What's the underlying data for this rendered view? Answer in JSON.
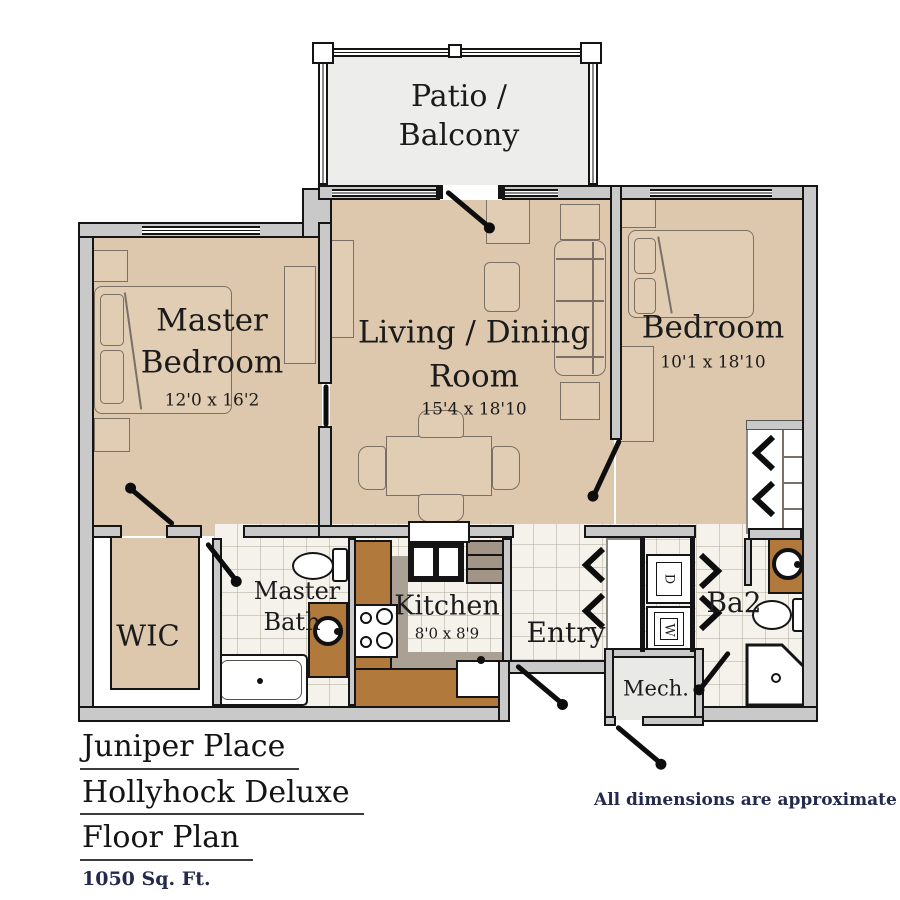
{
  "patio": {
    "line1": "Patio /",
    "line2": "Balcony"
  },
  "rooms": {
    "master_bedroom": {
      "line1": "Master",
      "line2": "Bedroom",
      "dims": "12'0 x 16'2"
    },
    "living": {
      "line1": "Living / Dining",
      "line2": "Room",
      "dims": "15'4 x 18'10"
    },
    "bedroom": {
      "label": "Bedroom",
      "dims": "10'1 x 18'10"
    },
    "wic": {
      "label": "WIC"
    },
    "master_bath": {
      "line1": "Master",
      "line2": "Bath"
    },
    "kitchen": {
      "label": "Kitchen",
      "dims": "8'0 x 8'9"
    },
    "entry": {
      "label": "Entry"
    },
    "ba2": {
      "label": "Ba2"
    },
    "mech": {
      "label": "Mech."
    },
    "laundry": {
      "dryer": "D",
      "washer": "W"
    }
  },
  "title": {
    "line1": "Juniper Place",
    "line2": "Hollyhock Deluxe",
    "line3": "Floor Plan",
    "sqft": "1050 Sq. Ft."
  },
  "footnote": "All dimensions are approximate",
  "colors": {
    "carpet": "#ddc8ae",
    "tile": "#f5f2ec",
    "counter_wood": "#b1793c",
    "wall": "#c9c9c9",
    "accent_navy": "#242a4e"
  }
}
